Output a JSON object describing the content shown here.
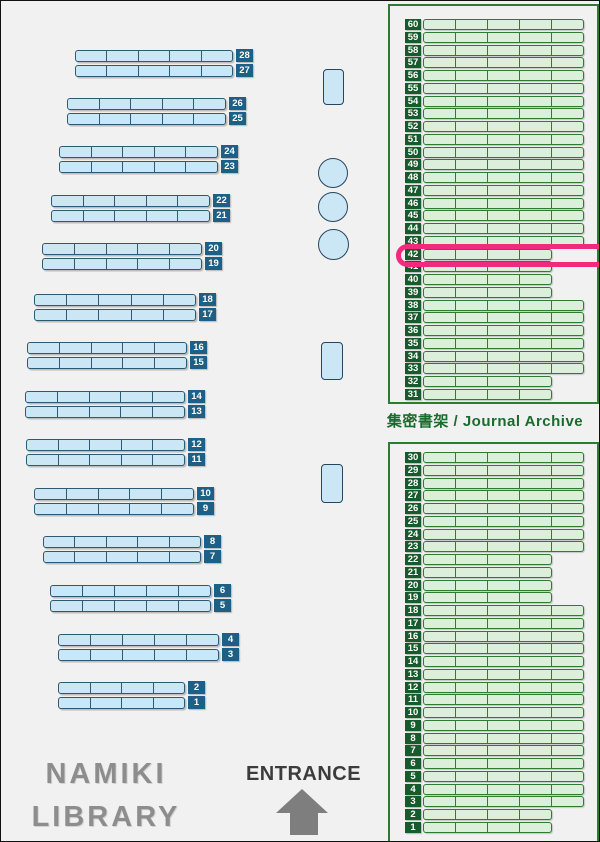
{
  "title": {
    "line1": "NAMIKI",
    "line2": "LIBRARY"
  },
  "entrance": {
    "label": "ENTRANCE"
  },
  "archive": {
    "label": "集密書架 / Journal Archive",
    "highlighted_shelf": "42",
    "top_panel": {
      "pairs": [
        {
          "shelves": [
            "60",
            "59"
          ],
          "length": "long"
        },
        {
          "shelves": [
            "58",
            "57"
          ],
          "length": "long"
        },
        {
          "shelves": [
            "56",
            "55"
          ],
          "length": "long"
        },
        {
          "shelves": [
            "54",
            "53"
          ],
          "length": "long"
        },
        {
          "shelves": [
            "52",
            "51"
          ],
          "length": "long"
        },
        {
          "shelves": [
            "50",
            "49"
          ],
          "length": "long"
        },
        {
          "shelves": [
            "48",
            "47"
          ],
          "length": "long"
        },
        {
          "shelves": [
            "46",
            "45"
          ],
          "length": "long"
        },
        {
          "shelves": [
            "44",
            "43"
          ],
          "length": "long"
        },
        {
          "shelves": [
            "42",
            "41"
          ],
          "length": "short"
        },
        {
          "shelves": [
            "40",
            "39"
          ],
          "length": "short"
        },
        {
          "shelves": [
            "38",
            "37"
          ],
          "length": "long"
        },
        {
          "shelves": [
            "36",
            "35"
          ],
          "length": "long"
        },
        {
          "shelves": [
            "34",
            "33"
          ],
          "length": "long"
        },
        {
          "shelves": [
            "32",
            "31"
          ],
          "length": "short"
        }
      ]
    },
    "bottom_panel": {
      "pairs": [
        {
          "shelves": [
            "30",
            "29"
          ],
          "length": "long"
        },
        {
          "shelves": [
            "28",
            "27"
          ],
          "length": "long"
        },
        {
          "shelves": [
            "26",
            "25"
          ],
          "length": "long"
        },
        {
          "shelves": [
            "24",
            "23"
          ],
          "length": "long"
        },
        {
          "shelves": [
            "22",
            "21"
          ],
          "length": "short"
        },
        {
          "shelves": [
            "20",
            "19"
          ],
          "length": "short"
        },
        {
          "shelves": [
            "18",
            "17"
          ],
          "length": "long"
        },
        {
          "shelves": [
            "16",
            "15"
          ],
          "length": "long"
        },
        {
          "shelves": [
            "14",
            "13"
          ],
          "length": "long"
        },
        {
          "shelves": [
            "12",
            "11"
          ],
          "length": "long"
        },
        {
          "shelves": [
            "10",
            "9"
          ],
          "length": "long"
        },
        {
          "shelves": [
            "8",
            "7"
          ],
          "length": "long"
        },
        {
          "shelves": [
            "6",
            "5"
          ],
          "length": "long"
        },
        {
          "shelves": [
            "4",
            "3"
          ],
          "length": "long"
        },
        {
          "shelves": [
            "2",
            "1"
          ],
          "length": "short"
        }
      ]
    }
  },
  "floor_shelves": {
    "pairs": [
      {
        "shelves": [
          "28",
          "27"
        ],
        "x": 74,
        "y": 48,
        "width": 158,
        "segments": 5
      },
      {
        "shelves": [
          "26",
          "25"
        ],
        "x": 66,
        "y": 96,
        "width": 159,
        "segments": 5
      },
      {
        "shelves": [
          "24",
          "23"
        ],
        "x": 58,
        "y": 144,
        "width": 159,
        "segments": 5
      },
      {
        "shelves": [
          "22",
          "21"
        ],
        "x": 50,
        "y": 193,
        "width": 159,
        "segments": 5
      },
      {
        "shelves": [
          "20",
          "19"
        ],
        "x": 41,
        "y": 241,
        "width": 160,
        "segments": 5
      },
      {
        "shelves": [
          "18",
          "17"
        ],
        "x": 33,
        "y": 292,
        "width": 162,
        "segments": 5
      },
      {
        "shelves": [
          "16",
          "15"
        ],
        "x": 26,
        "y": 340,
        "width": 160,
        "segments": 5
      },
      {
        "shelves": [
          "14",
          "13"
        ],
        "x": 24,
        "y": 389,
        "width": 160,
        "segments": 5
      },
      {
        "shelves": [
          "12",
          "11"
        ],
        "x": 25,
        "y": 437,
        "width": 159,
        "segments": 5
      },
      {
        "shelves": [
          "10",
          "9"
        ],
        "x": 33,
        "y": 486,
        "width": 160,
        "segments": 5
      },
      {
        "shelves": [
          "8",
          "7"
        ],
        "x": 42,
        "y": 534,
        "width": 158,
        "segments": 5
      },
      {
        "shelves": [
          "6",
          "5"
        ],
        "x": 49,
        "y": 583,
        "width": 161,
        "segments": 5
      },
      {
        "shelves": [
          "4",
          "3"
        ],
        "x": 57,
        "y": 632,
        "width": 161,
        "segments": 5
      },
      {
        "shelves": [
          "2",
          "1"
        ],
        "x": 57,
        "y": 680,
        "width": 127,
        "segments": 4
      }
    ]
  },
  "fixtures": {
    "pillars": [
      {
        "x": 322,
        "y": 68,
        "w": 21,
        "h": 36
      },
      {
        "x": 320,
        "y": 341,
        "w": 22,
        "h": 38
      },
      {
        "x": 320,
        "y": 463,
        "w": 22,
        "h": 39
      }
    ],
    "circles": [
      {
        "x": 317,
        "y": 157,
        "d": 30
      },
      {
        "x": 317,
        "y": 191,
        "d": 30
      },
      {
        "x": 317,
        "y": 228,
        "d": 31
      }
    ]
  },
  "colors": {
    "background": "#f1f1f1",
    "blue_fill": "#cbe7f6",
    "blue_border": "#2d5a70",
    "blue_tag": "#1e6085",
    "pillar_border": "#27455c",
    "green_fill": "#dcefdb",
    "green_border": "#2e7b31",
    "green_tag": "#165b2b",
    "green_text": "#1a6b2e",
    "highlight_pink": "#f02a7c",
    "gray_title": "#8d8d8d",
    "dark_text": "#3c3c3c",
    "arrow_gray": "#7e7e7e"
  }
}
